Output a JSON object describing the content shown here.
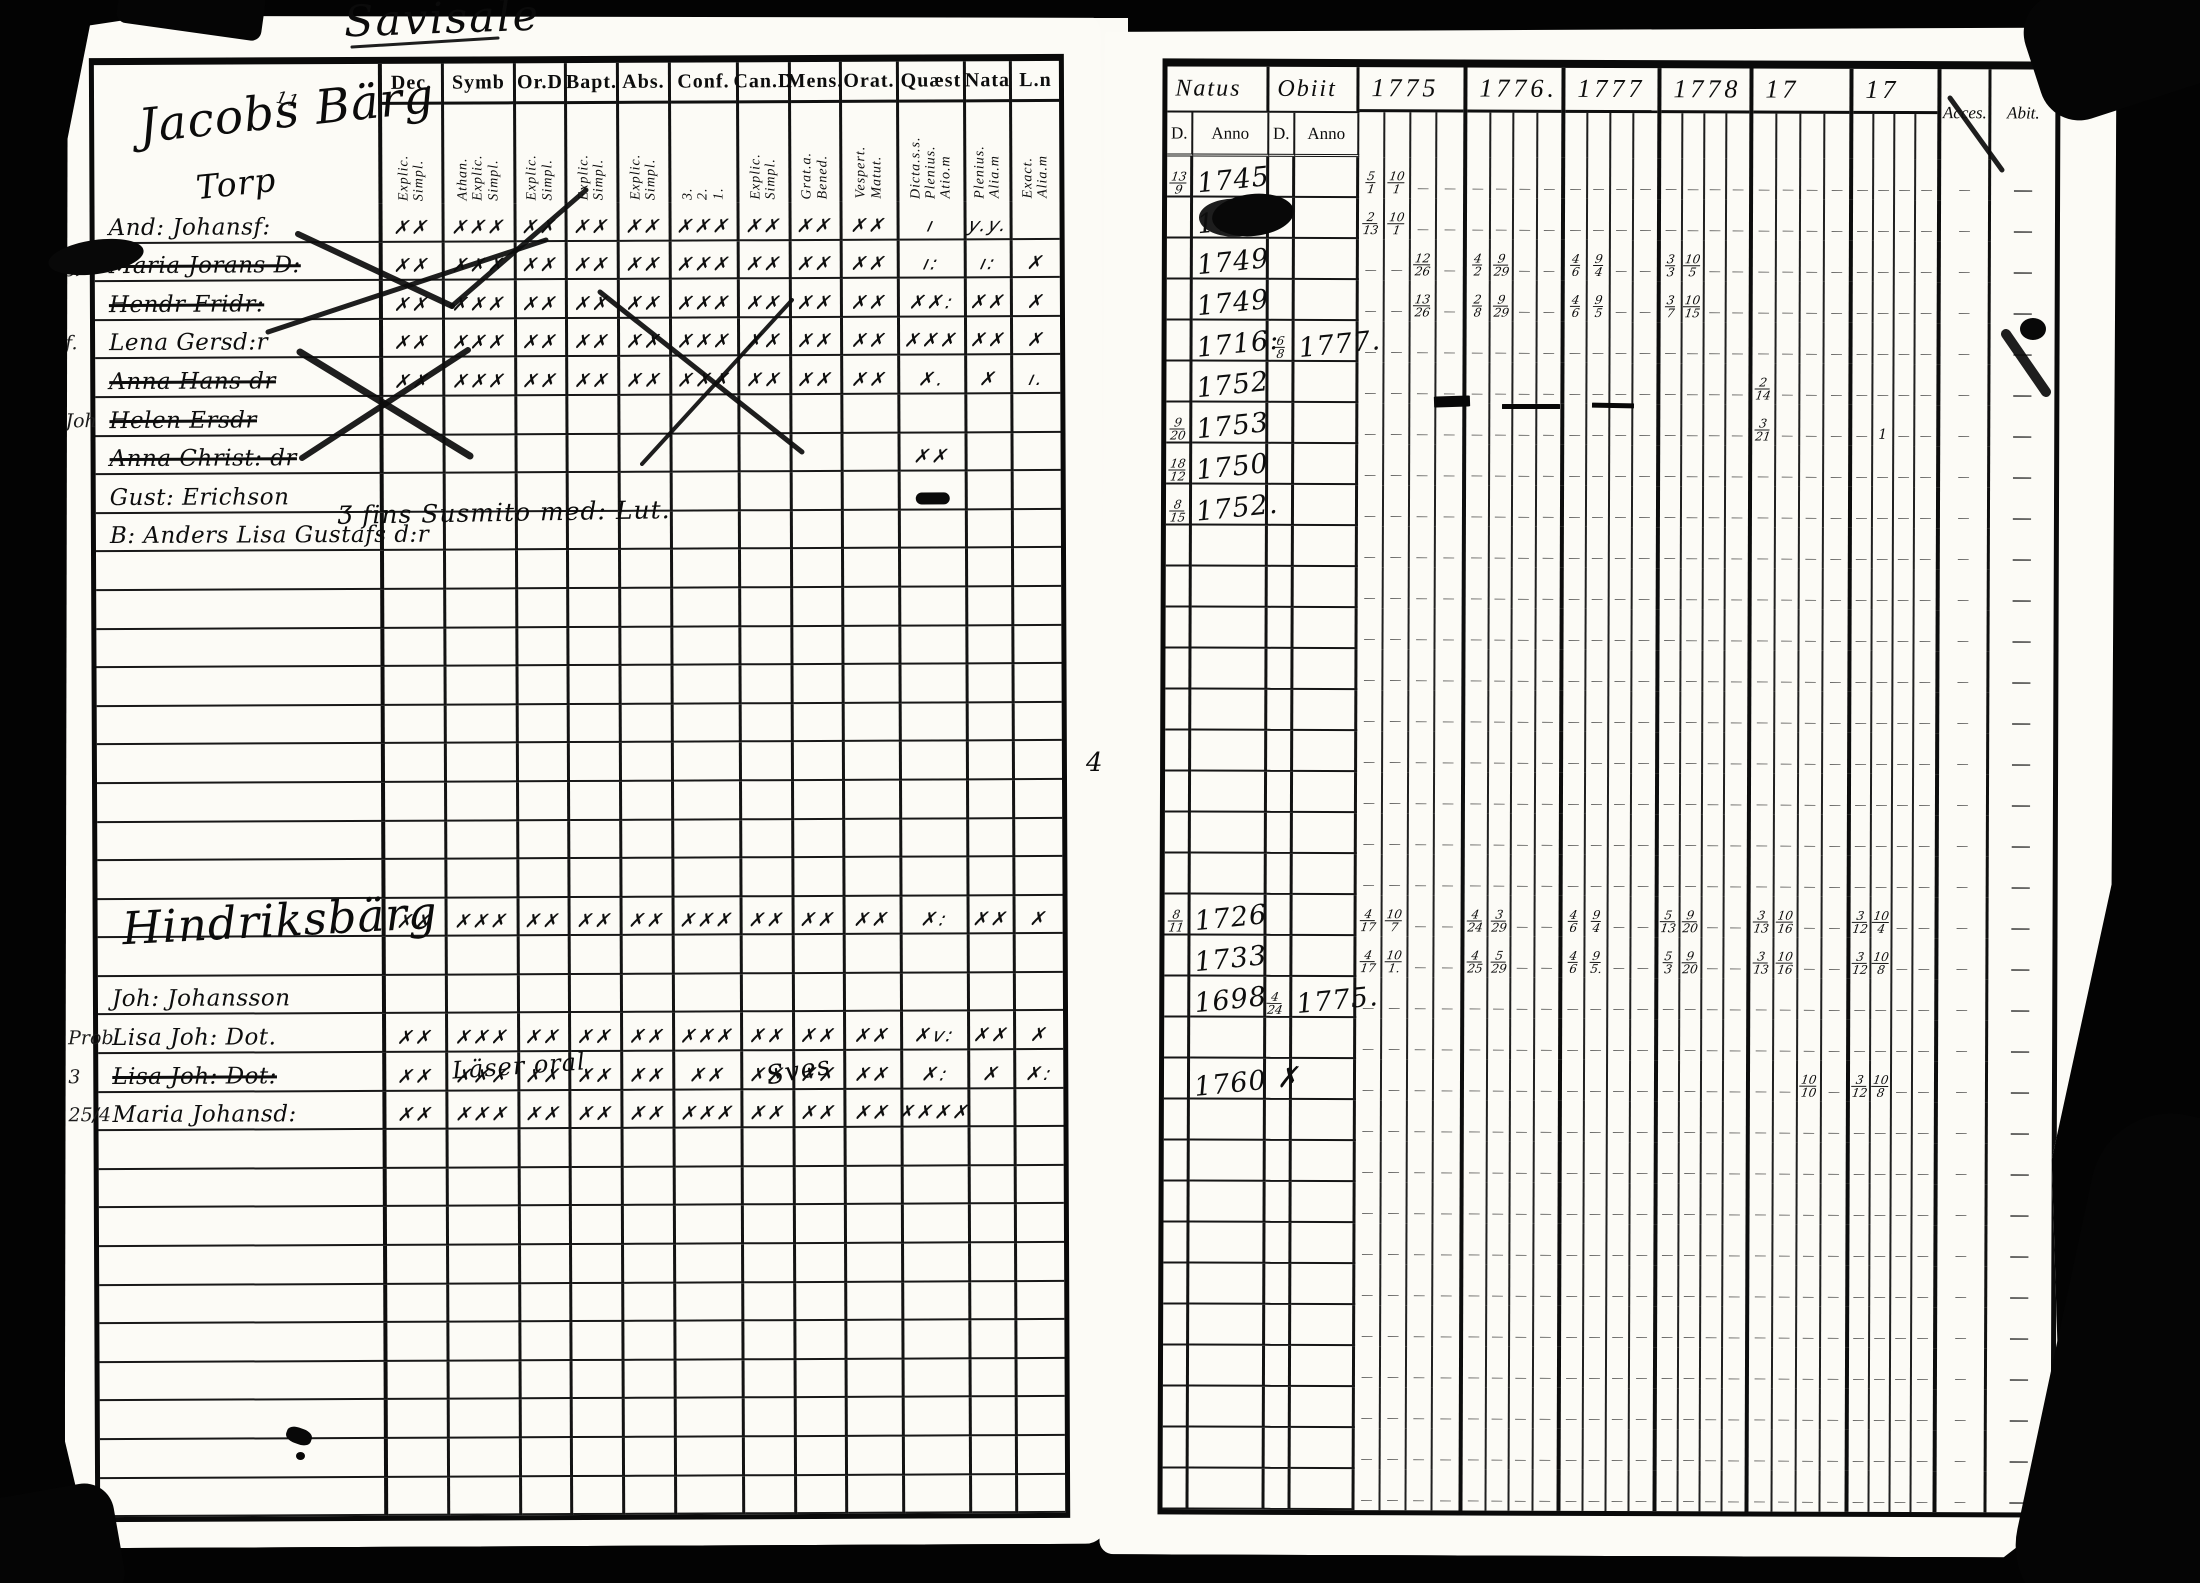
{
  "title": "Savisale",
  "left_page": {
    "columns": [
      {
        "label": "Dec.",
        "sub": "Explic. Simpl."
      },
      {
        "label": "Symb",
        "sub": "Athan. Explic. Simpl."
      },
      {
        "label": "Or.D",
        "sub": "Explic. Simpl."
      },
      {
        "label": "Bapt.",
        "sub": "Explic. Simpl."
      },
      {
        "label": "Abs.",
        "sub": "Explic. Simpl."
      },
      {
        "label": "Conf.",
        "sub": "3. 2. 1."
      },
      {
        "label": "Can.D",
        "sub": "Explic. Simpl."
      },
      {
        "label": "Mens.",
        "sub": "Grat.a. Bened."
      },
      {
        "label": "Orat.",
        "sub": "Vespert. Matut."
      },
      {
        "label": "Quæst",
        "sub": "Dicta.s.s. Plenius. Atio.m"
      },
      {
        "label": "Nata",
        "sub": "Plenius. Alia.m"
      },
      {
        "label": "L.n",
        "sub": "Exact. Alia.m"
      }
    ],
    "row_count": 34,
    "rows": {
      "0": {
        "name": "And: Johansf:",
        "marks": [
          "✗✗",
          "✗✗✗",
          "✗✗",
          "✗✗",
          "✗✗",
          "✗✗✗",
          "✗✗",
          "✗✗",
          "✗✗",
          "ı",
          "y.y.",
          ""
        ]
      },
      "1": {
        "margin": "gf.",
        "name": "Maria Jorans D:",
        "strike": true,
        "marks": [
          "✗✗",
          "✗✗✗",
          "✗✗",
          "✗✗",
          "✗✗",
          "✗✗✗",
          "✗✗",
          "✗✗",
          "✗✗",
          "ı:",
          "ı:",
          "✗"
        ]
      },
      "2": {
        "name": "Hendr Fridr:",
        "strike": true,
        "marks": [
          "✗✗",
          "✗✗✗",
          "✗✗",
          "✗✗",
          "✗✗",
          "✗✗✗",
          "✗✗",
          "✗✗",
          "✗✗",
          "✗✗:",
          "✗✗",
          "✗"
        ]
      },
      "3": {
        "margin": "f.",
        "name": "Lena Gersd:r",
        "marks": [
          "✗✗",
          "✗✗✗",
          "✗✗",
          "✗✗",
          "✗✗",
          "✗✗✗",
          "✗✗",
          "✗✗",
          "✗✗",
          "✗✗✗",
          "✗✗",
          "✗"
        ]
      },
      "4": {
        "name": "Anna Hans dr",
        "strike": true,
        "marks": [
          "✗✗",
          "✗✗✗",
          "✗✗",
          "✗✗",
          "✗✗",
          "✗✗✗",
          "✗✗",
          "✗✗",
          "✗✗",
          "✗.",
          "✗",
          "ı."
        ]
      },
      "5": {
        "margin": "Joh",
        "name": "Helen Ersdr",
        "strike": true,
        "marks": [
          "",
          "",
          "",
          "",
          "",
          "",
          "",
          "",
          "",
          "",
          "",
          ""
        ]
      },
      "6": {
        "name": "Anna Christ: dr",
        "strike": true,
        "marks": [
          "",
          "",
          "",
          "",
          "",
          "",
          "",
          "",
          "",
          "✗✗",
          "",
          ""
        ]
      },
      "7": {
        "name": "Gust: Erichson",
        "marks": [
          "",
          "",
          "",
          "",
          "",
          "",
          "",
          "",
          "",
          "▬",
          "",
          ""
        ]
      },
      "8": {
        "name": "B: Anders Lisa Gustafs d:r"
      },
      "18": {
        "marks": [
          "✗✗",
          "✗✗✗",
          "✗✗",
          "✗✗",
          "✗✗",
          "✗✗✗",
          "✗✗",
          "✗✗",
          "✗✗",
          "✗:",
          "✗✗",
          "✗"
        ]
      },
      "20": {
        "name": "Joh: Johansson"
      },
      "21": {
        "margin": "Prob",
        "name": "Lisa Joh: Dot.",
        "marks": [
          "✗✗",
          "✗✗✗",
          "✗✗",
          "✗✗",
          "✗✗",
          "✗✗✗",
          "✗✗",
          "✗✗",
          "✗✗",
          "✗v:",
          "✗✗",
          "✗"
        ]
      },
      "22": {
        "margin": "3",
        "name": "Lisa Joh: Dot:",
        "strike": true,
        "marks": [
          "✗✗",
          "✗✗✗",
          "✗✗",
          "✗✗",
          "✗✗",
          "✗✗",
          "✗✗",
          "✗✗",
          "✗✗",
          "✗:",
          "✗",
          "✗:"
        ]
      },
      "23": {
        "margin": "25/4",
        "name": "Maria Johansd:",
        "marks": [
          "✗✗",
          "✗✗✗",
          "✗✗",
          "✗✗",
          "✗✗",
          "✗✗✗",
          "✗✗",
          "✗✗",
          "✗✗",
          "✗✗✗✗",
          "",
          ""
        ]
      }
    }
  },
  "right_page": {
    "header": {
      "natus": "Natus",
      "obiit": "Obiit",
      "d": "D.",
      "anno": "Anno",
      "years": [
        "1775",
        "1776.",
        "1777",
        "1778",
        "17",
        "17"
      ],
      "acces": "Acces.",
      "abit": "Abit."
    },
    "row_count": 33,
    "rows": {
      "0": {
        "d": "13/9",
        "anno": "1745",
        "y": {
          "0": [
            "5/1",
            "10/1"
          ]
        }
      },
      "1": {
        "anno": "1745",
        "blot": true,
        "y": {
          "0": [
            "2/13",
            "10/1"
          ]
        }
      },
      "2": {
        "anno": "1749",
        "y": {
          "0": [
            "",
            "",
            "12/26"
          ],
          "1": [
            "4/2",
            "9/29"
          ],
          "2": [
            "4/6",
            "9/4"
          ],
          "3": [
            "3/3",
            "10/5"
          ]
        }
      },
      "3": {
        "anno": "1749",
        "y": {
          "0": [
            "",
            "",
            "13/26"
          ],
          "1": [
            "2/8",
            "9/29"
          ],
          "2": [
            "4/6",
            "9/5"
          ],
          "3": [
            "3/7",
            "10/15"
          ]
        }
      },
      "4": {
        "anno": "1716:",
        "od": "6/8",
        "oa": "1777."
      },
      "5": {
        "anno": "1752",
        "y": {
          "4": [
            "2/14"
          ]
        }
      },
      "6": {
        "d": "9/20",
        "anno": "1753",
        "y": {
          "4": [
            "3/21"
          ],
          "5": [
            "",
            "1"
          ]
        }
      },
      "7": {
        "d": "18/12",
        "anno": "1750"
      },
      "8": {
        "d": "8/15",
        "anno": "1752."
      },
      "18": {
        "d": "8/11",
        "anno": "1726",
        "y": {
          "0": [
            "4/17",
            "10/7"
          ],
          "1": [
            "4/24",
            "3/29"
          ],
          "2": [
            "4/6",
            "9/4"
          ],
          "3": [
            "5/13",
            "9/20"
          ],
          "4": [
            "3/13",
            "10/16"
          ],
          "5": [
            "3/12",
            "10/4"
          ]
        }
      },
      "19": {
        "anno": "1733",
        "y": {
          "0": [
            "4/17",
            "10/1."
          ],
          "1": [
            "4/25",
            "5/29"
          ],
          "2": [
            "4/6",
            "9/5."
          ],
          "3": [
            "5/3",
            "9/20"
          ],
          "4": [
            "3/13",
            "10/16"
          ],
          "5": [
            "3/12",
            "10/8"
          ]
        }
      },
      "20": {
        "anno": "1698",
        "sup": "4/24",
        "oa": "1775."
      },
      "22": {
        "anno": "1760 ✗",
        "y": {
          "4": [
            "",
            "",
            "10/10"
          ],
          "5": [
            "3/12",
            "10/8"
          ]
        }
      }
    }
  },
  "overlays": {
    "texts": [
      {
        "name": "heading-jacobsberg",
        "text": "Jacobs Bärg",
        "x": 138,
        "y": 84,
        "size": 47,
        "rot": -6
      },
      {
        "name": "heading-note-11",
        "text": "11",
        "x": 276,
        "y": 90,
        "size": 17,
        "rot": 12
      },
      {
        "name": "heading-torp",
        "text": "Torp",
        "x": 196,
        "y": 164,
        "size": 33,
        "rot": -6
      },
      {
        "name": "note-finska",
        "text": "Ʒ  fins Susmito   med: Lut.",
        "x": 338,
        "y": 498,
        "size": 25,
        "rot": -1
      },
      {
        "name": "heading-hindriksberg",
        "text": "Hindriksbärg",
        "x": 122,
        "y": 894,
        "size": 45,
        "rot": -3
      },
      {
        "name": "note-laser-oral",
        "text": "Läser oral",
        "x": 452,
        "y": 1052,
        "size": 24,
        "rot": -4
      },
      {
        "name": "note-sves",
        "text": "Sves",
        "x": 766,
        "y": 1056,
        "size": 26,
        "rot": -10
      },
      {
        "name": "gutter-numeral",
        "text": "4",
        "x": 1086,
        "y": 748,
        "size": 26,
        "rot": 0
      }
    ],
    "blobs": [
      {
        "x": 48,
        "y": 240,
        "w": 96,
        "h": 34,
        "r": 60,
        "rot": -8
      },
      {
        "x": 1212,
        "y": 194,
        "w": 82,
        "h": 42,
        "r": 50,
        "rot": -6
      },
      {
        "x": 1434,
        "y": 396,
        "w": 36,
        "h": 11,
        "r": 6,
        "rot": -2
      },
      {
        "x": 1502,
        "y": 404,
        "w": 58,
        "h": 5,
        "r": 3,
        "rot": 0
      },
      {
        "x": 1592,
        "y": 403,
        "w": 42,
        "h": 5,
        "r": 3,
        "rot": 1
      },
      {
        "x": 2020,
        "y": 318,
        "w": 26,
        "h": 22,
        "r": 50,
        "rot": 0
      },
      {
        "x": 286,
        "y": 1428,
        "w": 26,
        "h": 16,
        "r": 40,
        "rot": 20
      },
      {
        "x": 296,
        "y": 1452,
        "w": 9,
        "h": 8,
        "r": 50,
        "rot": 0
      }
    ],
    "strokes": [
      {
        "x1": 298,
        "y1": 234,
        "x2": 452,
        "y2": 306,
        "w": 6
      },
      {
        "x1": 452,
        "y1": 306,
        "x2": 586,
        "y2": 190,
        "w": 5
      },
      {
        "x1": 268,
        "y1": 332,
        "x2": 546,
        "y2": 240,
        "w": 5
      },
      {
        "x1": 300,
        "y1": 352,
        "x2": 470,
        "y2": 456,
        "w": 7
      },
      {
        "x1": 468,
        "y1": 350,
        "x2": 302,
        "y2": 458,
        "w": 6
      },
      {
        "x1": 600,
        "y1": 292,
        "x2": 802,
        "y2": 452,
        "w": 5
      },
      {
        "x1": 792,
        "y1": 300,
        "x2": 642,
        "y2": 464,
        "w": 4
      },
      {
        "x1": 1950,
        "y1": 98,
        "x2": 2002,
        "y2": 170,
        "w": 5
      },
      {
        "x1": 2006,
        "y1": 334,
        "x2": 2046,
        "y2": 392,
        "w": 10
      },
      {
        "x1": 352,
        "y1": 47,
        "x2": 498,
        "y2": 38,
        "w": 3
      }
    ]
  }
}
